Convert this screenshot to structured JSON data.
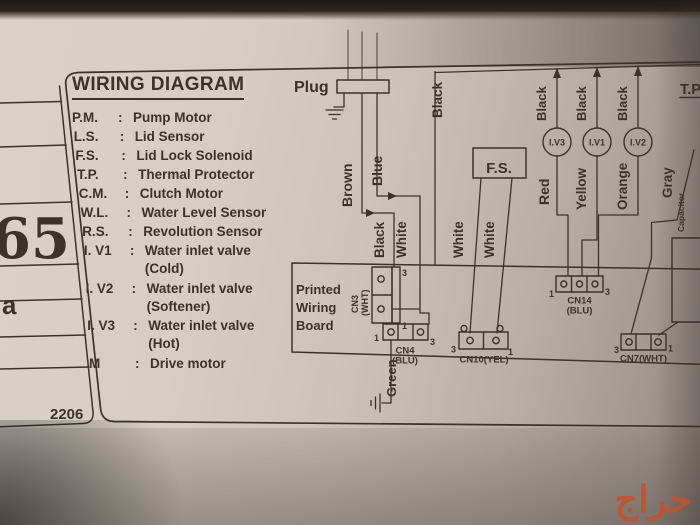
{
  "side_panel": {
    "cell_big": "65",
    "cell_small": "a",
    "code": "2206"
  },
  "legend": {
    "title": "WIRING DIAGRAM",
    "colon": ":",
    "items": [
      {
        "abbr": "P.M.",
        "def": "Pump Motor"
      },
      {
        "abbr": "L.S.",
        "def": "Lid Sensor"
      },
      {
        "abbr": "F.S.",
        "def": "Lid Lock Solenoid"
      },
      {
        "abbr": "T.P.",
        "def": "Thermal Protector"
      },
      {
        "abbr": "C.M.",
        "def": "Clutch Motor"
      },
      {
        "abbr": "W.L.",
        "def": "Water Level Sensor"
      },
      {
        "abbr": "R.S.",
        "def": "Revolution Sensor"
      },
      {
        "abbr": "I. V1",
        "def": "Water inlet valve",
        "sub": "(Cold)"
      },
      {
        "abbr": "I. V2",
        "def": "Water inlet valve",
        "sub": "(Softener)"
      },
      {
        "abbr": "I. V3",
        "def": "Water inlet valve",
        "sub": "(Hot)"
      },
      {
        "abbr": "M",
        "def": "Drive motor"
      }
    ]
  },
  "diagram": {
    "plug": "Plug",
    "tp": "T.P",
    "fs": "F.S.",
    "board": {
      "l1": "Printed",
      "l2": "Wiring",
      "l3": "Board"
    },
    "valves": {
      "v3": "I.V3",
      "v1": "I.V1",
      "v2": "I.V2"
    },
    "wires": {
      "brown": "Brown",
      "blue": "Blue",
      "black_a": "Black",
      "white_a": "White",
      "black_main": "Black",
      "white_f1": "White",
      "white_f2": "White",
      "black_v3": "Black",
      "black_v1": "Black",
      "black_v2": "Black",
      "red": "Red",
      "yellow": "Yellow",
      "orange": "Orange",
      "gray": "Gray",
      "green": "Green",
      "capacitor": "Capacitor"
    },
    "connectors": {
      "cn3": {
        "name": "CN3",
        "color": "(WHT)",
        "p_top": "3",
        "p_bot": "1"
      },
      "cn4": {
        "name": "CN4",
        "color": "(BLU)",
        "p_left": "1",
        "p_right": "3"
      },
      "cn14": {
        "name": "CN14",
        "color": "(BLU)",
        "p_left": "1",
        "p_right": "3"
      },
      "cn10": {
        "name": "CN10(YEL)",
        "p_left": "3",
        "p_right": "1"
      },
      "cn7": {
        "name": "CN7(WHT)",
        "p_left": "3",
        "p_right": "1"
      }
    }
  },
  "watermark": {
    "text": "حراج",
    "color": "#c4512b"
  },
  "colors": {
    "ink": "#3b322b",
    "label_bg": "#d5cdc5",
    "panel_dark": "#27201b"
  }
}
